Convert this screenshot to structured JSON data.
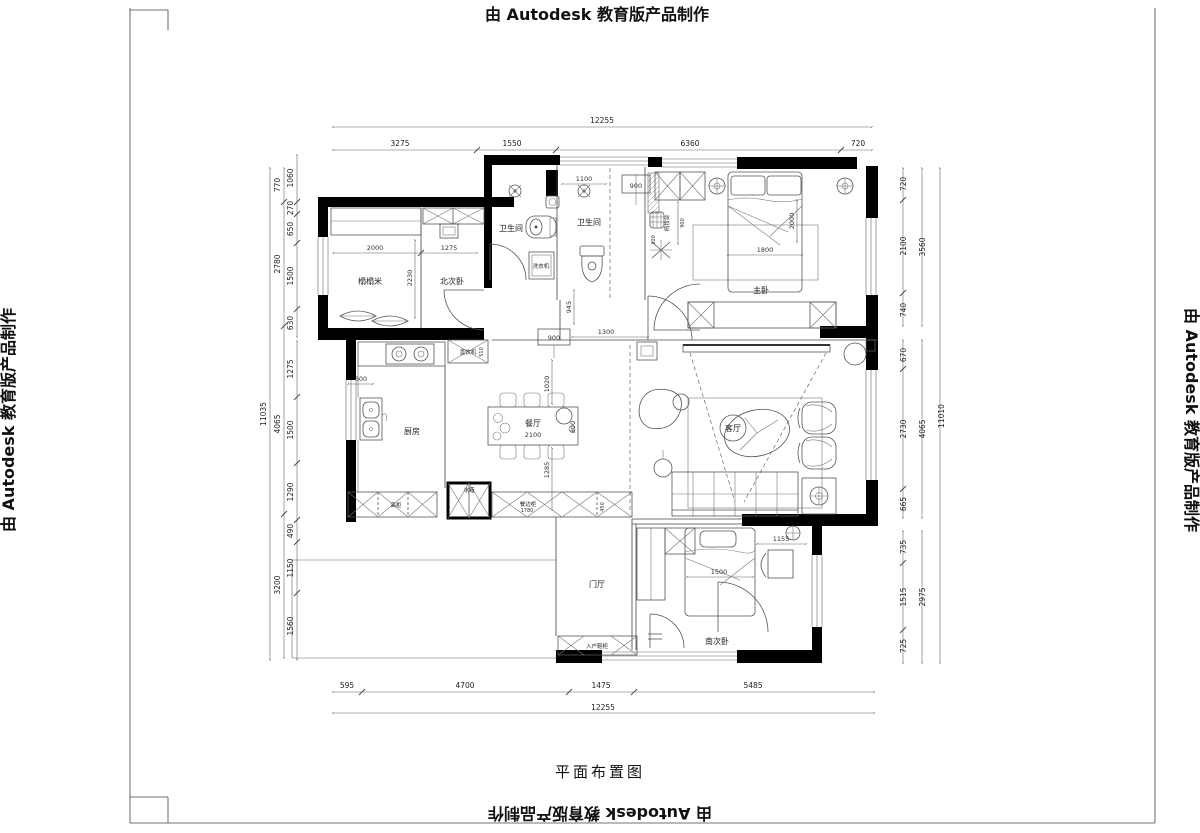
{
  "watermark": "由 Autodesk 教育版产品制作",
  "title": "平面布置图",
  "dims": {
    "top": {
      "total": "12255",
      "segments": [
        "3275",
        "1550",
        "6360",
        "720"
      ]
    },
    "bottom": {
      "total": "12255",
      "segments": [
        "595",
        "4700",
        "1475",
        "5485"
      ]
    },
    "left": {
      "total": "11035",
      "outer": [
        "770",
        "2780",
        "4065",
        "3200"
      ],
      "inner": [
        "1060",
        "270",
        "650",
        "1500",
        "630",
        "1275",
        "1500",
        "1290",
        "490",
        "1150",
        "1560"
      ]
    },
    "right": {
      "total": "11010",
      "outer": [
        "3560",
        "4065",
        "2975"
      ],
      "inner": [
        "720",
        "2100",
        "740",
        "670",
        "2730",
        "665",
        "735",
        "1515",
        "725"
      ]
    }
  },
  "rooms": {
    "tatami": "榻榻米",
    "north_bedroom": "北次卧",
    "bathroom_left": "卫生间",
    "bathroom_right": "卫生间",
    "master_bedroom": "主卧",
    "kitchen": "厨房",
    "dining": "餐厅",
    "living": "客厅",
    "foyer": "门厅",
    "south_bedroom": "南次卧"
  },
  "furniture": {
    "washing_machine": "洗衣机",
    "water_dispenser": "直饮机",
    "fridge": "冰箱",
    "sideboard": "餐边柜",
    "tall_cabinet": "高柜",
    "shoe_cabinet": "入户鞋柜",
    "dresser": "梳妆台"
  },
  "inner_dims": {
    "tatami_w": "2000",
    "north_w": "1275",
    "tatami_d": "2230",
    "bath_w": "1100",
    "vanity": "900",
    "hall_h": "945",
    "hall_box": "900",
    "hall_w": "1300",
    "dining_gap_top": "1020",
    "dining_gap_bottom": "1285",
    "table_w": "2100",
    "table_d": "800",
    "counter": "600",
    "sideboard_w": "1780",
    "sideboard_d": "450",
    "dispenser_d": "510",
    "bed_w": "1800",
    "bed_l": "2000",
    "dresser_d": "900",
    "plant": "300",
    "south_bed_w": "1500",
    "desk_w": "1155"
  }
}
